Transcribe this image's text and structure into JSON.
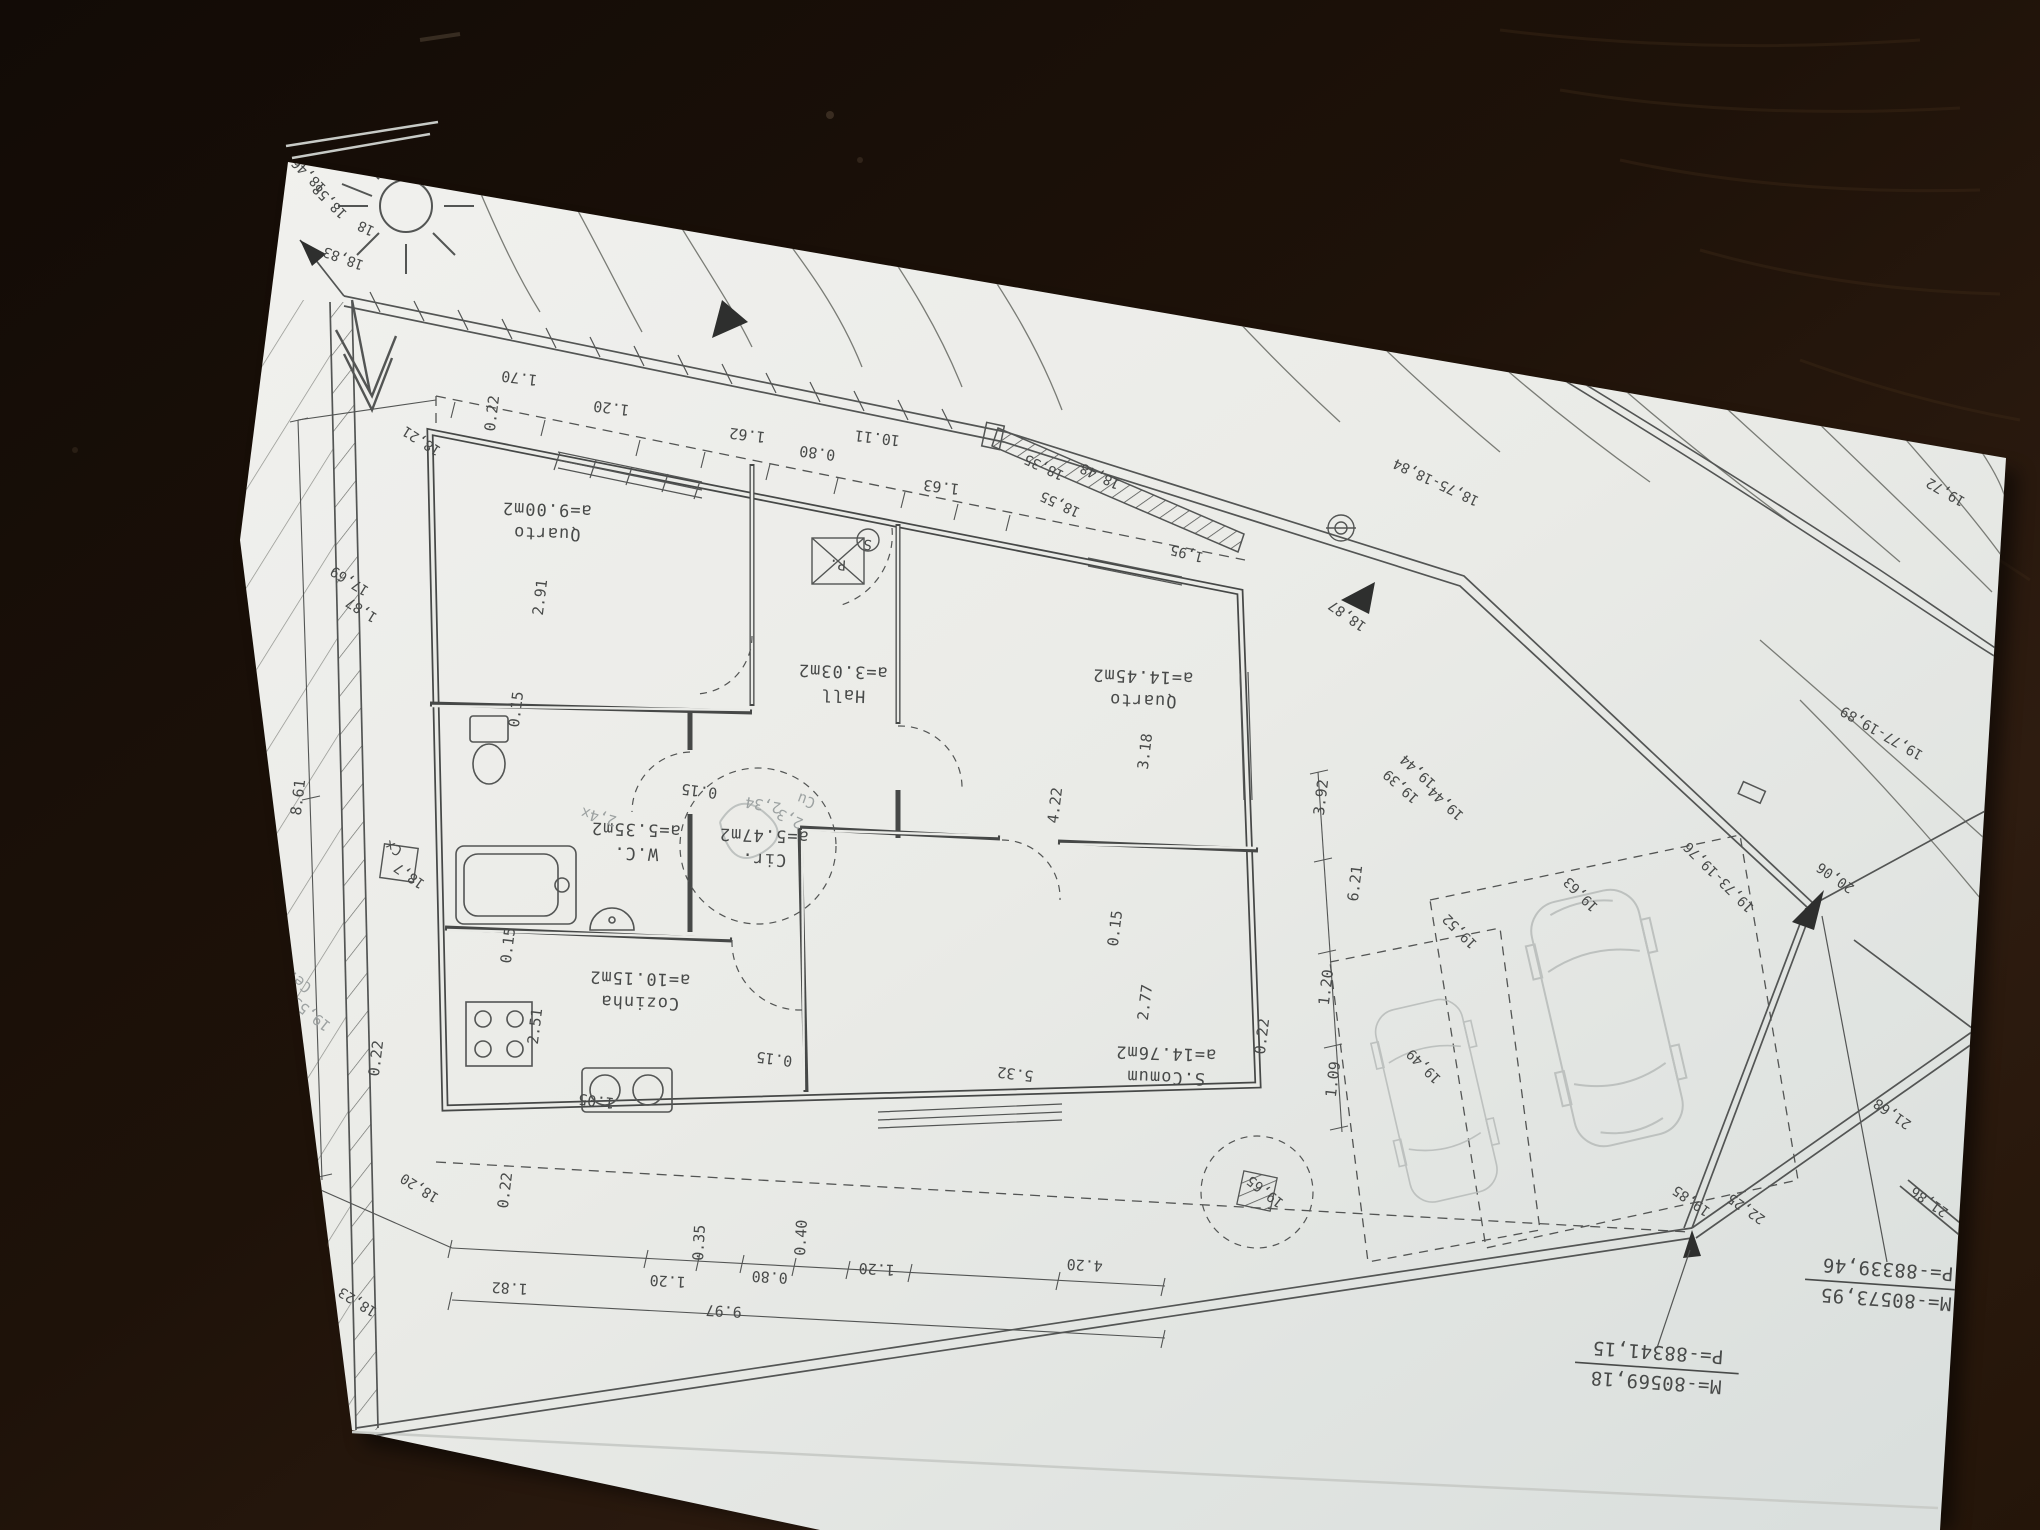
{
  "photo": {
    "table_color": "#1a1008",
    "paper_color": "#e9eae6",
    "ink_color": "#474747",
    "pencil_color": "#a6aaa9",
    "orientation_note": "plan drawing is rotated 180 degrees relative to camera"
  },
  "rooms": [
    {
      "name": "Quarto",
      "area": "a=9.00m2",
      "x": 547,
      "y": 516
    },
    {
      "name": "Hall",
      "area": "a=3.03m2",
      "x": 843,
      "y": 678
    },
    {
      "name": "Quarto",
      "area": "a=14.45m2",
      "x": 1143,
      "y": 683
    },
    {
      "name": "W.C.",
      "area": "a=5.35m2",
      "x": 636,
      "y": 836
    },
    {
      "name": "Cir.",
      "area": "a=5.47m2",
      "x": 764,
      "y": 842
    },
    {
      "name": "Cozinha",
      "area": "a=10.15m2",
      "x": 640,
      "y": 985
    },
    {
      "name": "S.Comum",
      "area": "a=14.76m2",
      "x": 1166,
      "y": 1060
    }
  ],
  "dimensions": [
    {
      "t": "1.70",
      "x": 520,
      "y": 373,
      "r": 187
    },
    {
      "t": "1.20",
      "x": 612,
      "y": 403,
      "r": 187
    },
    {
      "t": "1.62",
      "x": 748,
      "y": 430,
      "r": 187
    },
    {
      "t": "0.80",
      "x": 818,
      "y": 448,
      "r": 187
    },
    {
      "t": "10.11",
      "x": 878,
      "y": 433,
      "r": 187
    },
    {
      "t": "1.63",
      "x": 942,
      "y": 482,
      "r": 187
    },
    {
      "t": "0.22",
      "x": 497,
      "y": 414,
      "r": 277
    },
    {
      "t": "0.22",
      "x": 381,
      "y": 1059,
      "r": 277
    },
    {
      "t": "0.22",
      "x": 510,
      "y": 1191,
      "r": 277
    },
    {
      "t": "0.22",
      "x": 1267,
      "y": 1037,
      "r": 277
    },
    {
      "t": "0.15",
      "x": 521,
      "y": 710,
      "r": 277
    },
    {
      "t": "0.15",
      "x": 700,
      "y": 786,
      "r": 187
    },
    {
      "t": "0.15",
      "x": 513,
      "y": 946,
      "r": 277
    },
    {
      "t": "0.15",
      "x": 775,
      "y": 1054,
      "r": 187
    },
    {
      "t": "0.15",
      "x": 1120,
      "y": 929,
      "r": 277
    },
    {
      "t": "2.91",
      "x": 545,
      "y": 598,
      "r": 277
    },
    {
      "t": "2.51",
      "x": 540,
      "y": 1027,
      "r": 277
    },
    {
      "t": "3.18",
      "x": 1150,
      "y": 752,
      "r": 277
    },
    {
      "t": "4.22",
      "x": 1060,
      "y": 806,
      "r": 277
    },
    {
      "t": "2.77",
      "x": 1150,
      "y": 1003,
      "r": 277
    },
    {
      "t": "5.32",
      "x": 1016,
      "y": 1069,
      "r": 187
    },
    {
      "t": "1.05",
      "x": 597,
      "y": 1096,
      "r": 187
    },
    {
      "t": "3.92",
      "x": 1326,
      "y": 798,
      "r": 277
    },
    {
      "t": "6.21",
      "x": 1360,
      "y": 884,
      "r": 277
    },
    {
      "t": "1.20",
      "x": 1331,
      "y": 988,
      "r": 277
    },
    {
      "t": "1.09",
      "x": 1338,
      "y": 1080,
      "r": 277
    },
    {
      "t": "4.20",
      "x": 1085,
      "y": 1260,
      "r": 183
    },
    {
      "t": "1.20",
      "x": 877,
      "y": 1264,
      "r": 183
    },
    {
      "t": "0.40",
      "x": 806,
      "y": 1238,
      "r": 273
    },
    {
      "t": "0.80",
      "x": 770,
      "y": 1272,
      "r": 183
    },
    {
      "t": "0.35",
      "x": 704,
      "y": 1243,
      "r": 273
    },
    {
      "t": "1.20",
      "x": 668,
      "y": 1276,
      "r": 183
    },
    {
      "t": "1.82",
      "x": 510,
      "y": 1283,
      "r": 183
    },
    {
      "t": "9.97",
      "x": 724,
      "y": 1306,
      "r": 183
    },
    {
      "t": "8.61",
      "x": 303,
      "y": 798,
      "r": 277
    }
  ],
  "elevations": [
    {
      "t": "18,46",
      "x": 312,
      "y": 172,
      "r": 225
    },
    {
      "t": "18,58",
      "x": 333,
      "y": 198,
      "r": 225
    },
    {
      "t": "18",
      "x": 368,
      "y": 224,
      "r": 205
    },
    {
      "t": "18,83",
      "x": 345,
      "y": 254,
      "r": 200
    },
    {
      "t": "38",
      "x": 706,
      "y": 198,
      "r": 203
    },
    {
      "t": "17,59",
      "x": 800,
      "y": 213,
      "r": 203
    },
    {
      "t": "18,21",
      "x": 424,
      "y": 437,
      "r": 212
    },
    {
      "t": "18,35",
      "x": 1046,
      "y": 463,
      "r": 205
    },
    {
      "t": "18,48",
      "x": 1102,
      "y": 472,
      "r": 205
    },
    {
      "t": "18,55",
      "x": 1062,
      "y": 500,
      "r": 205
    },
    {
      "t": "1,95",
      "x": 1188,
      "y": 549,
      "r": 194
    },
    {
      "t": "18,75-18,84",
      "x": 1438,
      "y": 478,
      "r": 205
    },
    {
      "t": "18,87",
      "x": 1350,
      "y": 612,
      "r": 215
    },
    {
      "t": "19,72",
      "x": 1948,
      "y": 488,
      "r": 210
    },
    {
      "t": "19,77-19,89",
      "x": 1884,
      "y": 729,
      "r": 210
    },
    {
      "t": "20,06",
      "x": 1838,
      "y": 874,
      "r": 215
    },
    {
      "t": "19,39",
      "x": 1404,
      "y": 783,
      "r": 222
    },
    {
      "t": "19,44",
      "x": 1421,
      "y": 768,
      "r": 222
    },
    {
      "t": "19,44",
      "x": 1449,
      "y": 800,
      "r": 222
    },
    {
      "t": "19,52",
      "x": 1463,
      "y": 928,
      "r": 225
    },
    {
      "t": "19,63",
      "x": 1584,
      "y": 891,
      "r": 225
    },
    {
      "t": "19,73-19,76",
      "x": 1722,
      "y": 874,
      "r": 225
    },
    {
      "t": "19,49",
      "x": 1427,
      "y": 1063,
      "r": 225
    },
    {
      "t": "19,65",
      "x": 1268,
      "y": 1188,
      "r": 218
    },
    {
      "t": "19,85",
      "x": 1694,
      "y": 1197,
      "r": 215
    },
    {
      "t": "22,25",
      "x": 1749,
      "y": 1205,
      "r": 215
    },
    {
      "t": "21,68",
      "x": 1895,
      "y": 1110,
      "r": 215
    },
    {
      "t": "21,86",
      "x": 1932,
      "y": 1198,
      "r": 215
    },
    {
      "t": "18,20",
      "x": 422,
      "y": 1184,
      "r": 212
    },
    {
      "t": "18,23",
      "x": 360,
      "y": 1298,
      "r": 212
    },
    {
      "t": "17,69",
      "x": 352,
      "y": 577,
      "r": 212
    },
    {
      "t": "1,87",
      "x": 364,
      "y": 606,
      "r": 212
    }
  ],
  "pencil_notes": [
    {
      "t": "Cerco",
      "x": 295,
      "y": 972,
      "r": 218
    },
    {
      "t": "19,53",
      "x": 314,
      "y": 1010,
      "r": 218
    },
    {
      "t": "Cu",
      "x": 808,
      "y": 796,
      "r": 200
    },
    {
      "t": "2,3",
      "x": 792,
      "y": 814,
      "r": 205
    },
    {
      "t": "2,34",
      "x": 764,
      "y": 800,
      "r": 190
    },
    {
      "t": "2,4x",
      "x": 600,
      "y": 812,
      "r": 195
    }
  ],
  "markers": [
    {
      "t": "P.",
      "x": 838,
      "y": 560,
      "r": 184
    },
    {
      "t": "S",
      "x": 868,
      "y": 540,
      "r": 184
    },
    {
      "t": "Cx",
      "x": 396,
      "y": 844,
      "r": 210
    },
    {
      "t": "18,7",
      "x": 412,
      "y": 872,
      "r": 215
    }
  ],
  "survey_marks": [
    {
      "m": "M=-80573,95",
      "p": "P=-88339,46",
      "x": 1887,
      "y": 1283,
      "r": 184
    },
    {
      "m": "M=-80569,18",
      "p": "P=-88341,15",
      "x": 1657,
      "y": 1366,
      "r": 184
    }
  ]
}
